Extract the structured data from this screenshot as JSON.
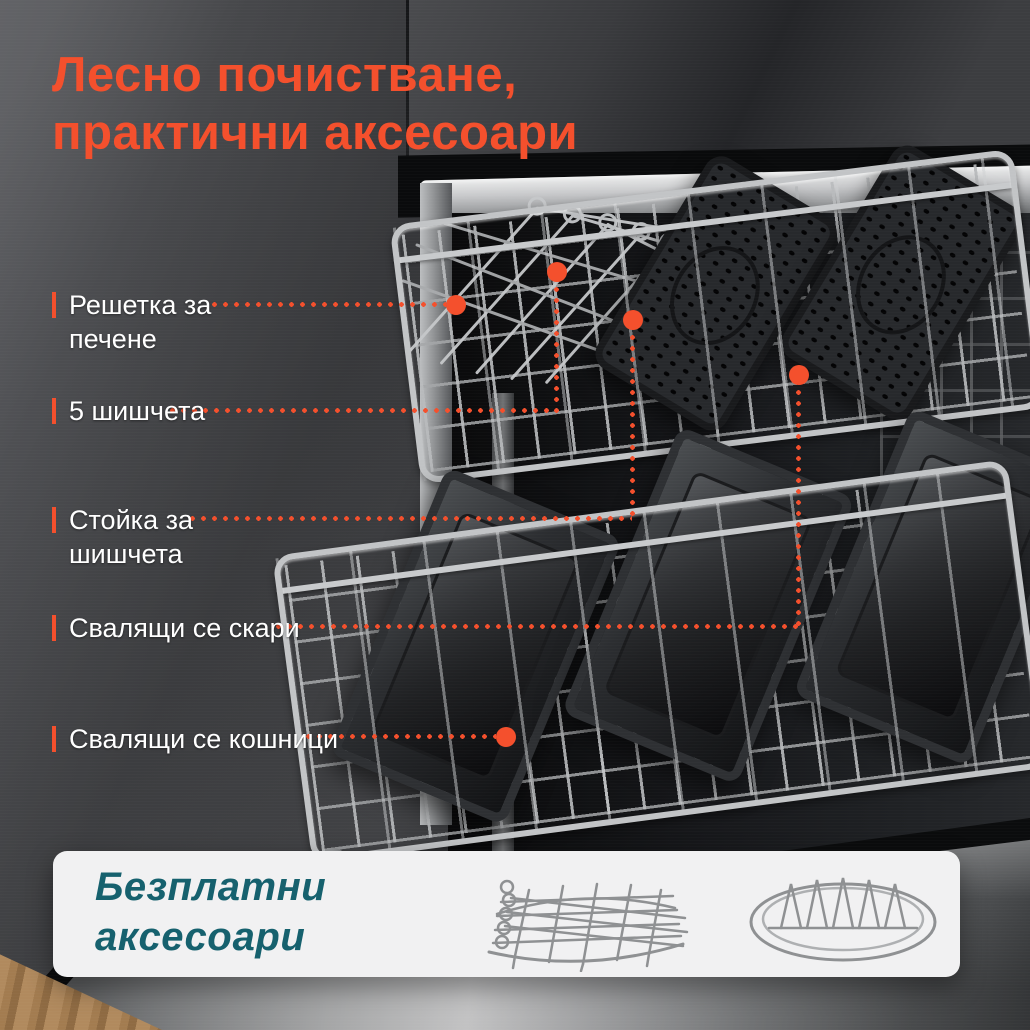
{
  "title": {
    "line1": "Лесно почистване,",
    "line2": "практични аксесоари"
  },
  "callouts": [
    {
      "line1": "Решетка за",
      "line2": "печене"
    },
    {
      "line1": "5 шишчета"
    },
    {
      "line1": "Стойка за",
      "line2": "шишчета"
    },
    {
      "line1": "Свалящи се скари"
    },
    {
      "line1": "Свалящи се кошници"
    }
  ],
  "card": {
    "line1": "Безплатни",
    "line2": "аксесоари",
    "accessories": [
      {
        "name": "skewer-rack"
      },
      {
        "name": "roasting-rack"
      }
    ]
  },
  "colors": {
    "accent": "#F4502D",
    "teal": "#16616E",
    "card_bg": "#F1F1F2",
    "label_text": "#FFFFFF"
  }
}
